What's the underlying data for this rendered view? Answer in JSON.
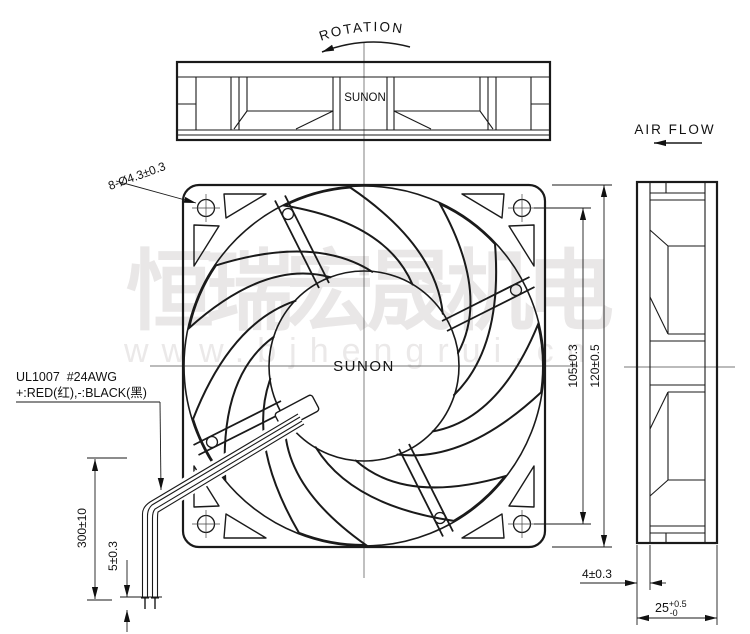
{
  "drawing": {
    "title_labels": {
      "rotation": "ROTATION",
      "air_flow": "AIR FLOW"
    },
    "brand": {
      "top_view": "SUNON",
      "hub": "SUNON"
    },
    "wire_label": {
      "line1": "UL1007  #24AWG",
      "line2": "+:RED(红),-:BLACK(黑)"
    },
    "dimensions": {
      "mounting_holes": "8-Ø4.3±0.3",
      "hole_pitch": "105±0.3",
      "frame_size": "120±0.5",
      "wire_length": "300±10",
      "wire_strip": "5±0.3",
      "inset_depth": "4±0.3",
      "frame_thickness": {
        "value": "25",
        "tol_upper": "+0.5",
        "tol_lower": "-0"
      }
    },
    "watermark": {
      "line1": "恒瑞宏晟机电",
      "line2": "www.bjhengrui.cn"
    }
  }
}
